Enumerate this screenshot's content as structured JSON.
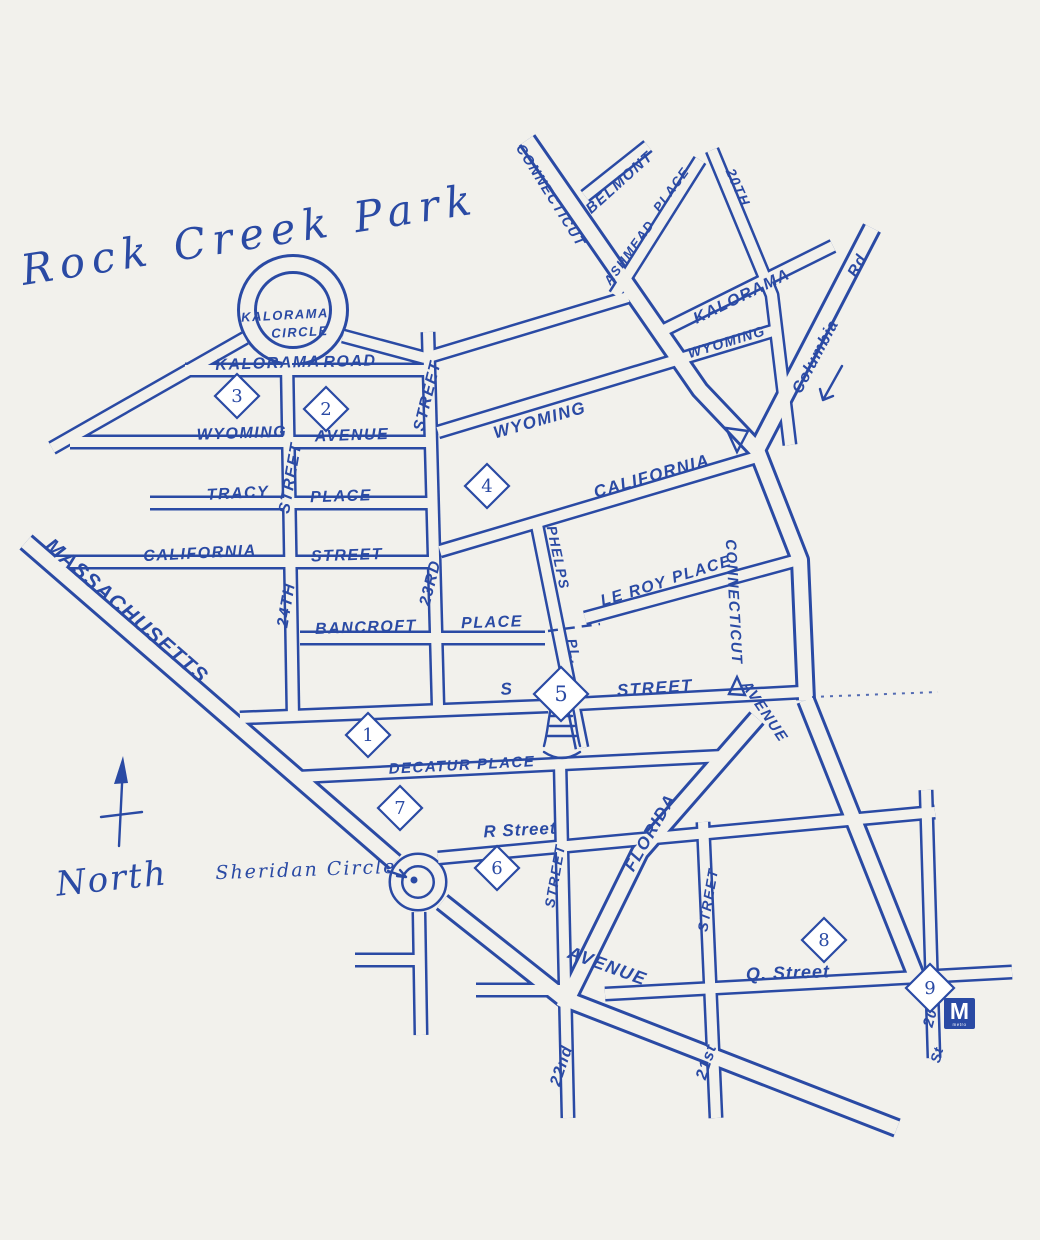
{
  "title": "Rock Creek Park",
  "colors": {
    "ink": "#2a4aa4",
    "paper": "#f2f1ec"
  },
  "labels": [
    {
      "id": "park-title",
      "text": "Rock Creek Park",
      "x": 250,
      "y": 238,
      "rot": -9,
      "size": 42,
      "cls": "script"
    },
    {
      "id": "kalorama-circle-line1",
      "text": "Kalorama",
      "x": 285,
      "y": 316,
      "rot": -3,
      "size": 13,
      "cls": "hand"
    },
    {
      "id": "kalorama-circle-line2",
      "text": "Circle",
      "x": 300,
      "y": 333,
      "rot": -3,
      "size": 13,
      "cls": "hand"
    },
    {
      "id": "kalorama-road-1",
      "text": "Kalorama",
      "x": 268,
      "y": 364,
      "rot": -2,
      "size": 16,
      "cls": "hand"
    },
    {
      "id": "kalorama-road-2",
      "text": "Road",
      "x": 350,
      "y": 362,
      "rot": -2,
      "size": 16,
      "cls": "hand"
    },
    {
      "id": "wyoming-ave-w-1",
      "text": "Wyoming",
      "x": 242,
      "y": 434,
      "rot": -2,
      "size": 16,
      "cls": "hand"
    },
    {
      "id": "wyoming-ave-w-2",
      "text": "Avenue",
      "x": 352,
      "y": 436,
      "rot": -2,
      "size": 16,
      "cls": "hand"
    },
    {
      "id": "tracy-place-1",
      "text": "Tracy",
      "x": 238,
      "y": 494,
      "rot": -3,
      "size": 16,
      "cls": "hand"
    },
    {
      "id": "tracy-place-2",
      "text": "Place",
      "x": 341,
      "y": 497,
      "rot": -2,
      "size": 16,
      "cls": "hand"
    },
    {
      "id": "california-st-1",
      "text": "California",
      "x": 200,
      "y": 554,
      "rot": -3,
      "size": 16,
      "cls": "hand"
    },
    {
      "id": "california-st-2",
      "text": "Street",
      "x": 347,
      "y": 556,
      "rot": -2,
      "size": 16,
      "cls": "hand"
    },
    {
      "id": "bancroft-1",
      "text": "Bancroft",
      "x": 366,
      "y": 628,
      "rot": -2,
      "size": 16,
      "cls": "hand"
    },
    {
      "id": "bancroft-2",
      "text": "Place",
      "x": 492,
      "y": 623,
      "rot": -2,
      "size": 16,
      "cls": "hand"
    },
    {
      "id": "s-street-1",
      "text": "S",
      "x": 507,
      "y": 690,
      "rot": -5,
      "size": 17,
      "cls": "hand"
    },
    {
      "id": "s-street-2",
      "text": "Street",
      "x": 655,
      "y": 689,
      "rot": -4,
      "size": 17,
      "cls": "hand"
    },
    {
      "id": "decatur-place",
      "text": "Decatur Place",
      "x": 462,
      "y": 766,
      "rot": -3,
      "size": 15,
      "cls": "hand"
    },
    {
      "id": "r-street",
      "text": "R Street",
      "x": 520,
      "y": 831,
      "rot": -3,
      "size": 17,
      "cls": "hand2"
    },
    {
      "id": "q-street",
      "text": "Q. Street",
      "x": 788,
      "y": 974,
      "rot": -2,
      "size": 18,
      "cls": "hand2"
    },
    {
      "id": "massachusetts",
      "text": "Massachusetts",
      "x": 126,
      "y": 612,
      "rot": 41,
      "size": 21,
      "cls": "hand"
    },
    {
      "id": "massachusetts-avenue",
      "text": "Avenue",
      "x": 607,
      "y": 967,
      "rot": 20,
      "size": 18,
      "cls": "hand"
    },
    {
      "id": "sheridan-circle",
      "text": "Sheridan Circle",
      "x": 306,
      "y": 871,
      "rot": -2,
      "size": 19,
      "cls": "script2"
    },
    {
      "id": "north",
      "text": "North",
      "x": 112,
      "y": 881,
      "rot": -6,
      "size": 34,
      "cls": "script2"
    },
    {
      "id": "street-24th-num",
      "text": "24th",
      "x": 287,
      "y": 605,
      "rot": -80,
      "size": 16,
      "cls": "hand"
    },
    {
      "id": "street-24th-word",
      "text": "Street",
      "x": 291,
      "y": 478,
      "rot": -80,
      "size": 16,
      "cls": "hand"
    },
    {
      "id": "street-23rd-num",
      "text": "23rd",
      "x": 431,
      "y": 583,
      "rot": -76,
      "size": 16,
      "cls": "hand"
    },
    {
      "id": "street-23rd-word",
      "text": "Street",
      "x": 428,
      "y": 396,
      "rot": -76,
      "size": 16,
      "cls": "hand"
    },
    {
      "id": "phelps-1",
      "text": "Phelps",
      "x": 557,
      "y": 558,
      "rot": 78,
      "size": 14,
      "cls": "hand"
    },
    {
      "id": "phelps-2",
      "text": "Pl.",
      "x": 573,
      "y": 652,
      "rot": 78,
      "size": 14,
      "cls": "hand"
    },
    {
      "id": "leroy-1",
      "text": "Le Roy",
      "x": 634,
      "y": 592,
      "rot": -17,
      "size": 16,
      "cls": "hand"
    },
    {
      "id": "leroy-2",
      "text": "Place",
      "x": 702,
      "y": 570,
      "rot": -17,
      "size": 16,
      "cls": "hand"
    },
    {
      "id": "wyoming-center",
      "text": "Wyoming",
      "x": 540,
      "y": 421,
      "rot": -16,
      "size": 17,
      "cls": "hand"
    },
    {
      "id": "california-center",
      "text": "California",
      "x": 652,
      "y": 477,
      "rot": -16,
      "size": 17,
      "cls": "hand"
    },
    {
      "id": "connecticut-top",
      "text": "Connecticut",
      "x": 550,
      "y": 196,
      "rot": 58,
      "size": 14,
      "cls": "hand"
    },
    {
      "id": "belmont",
      "text": "Belmont",
      "x": 620,
      "y": 183,
      "rot": -42,
      "size": 15,
      "cls": "hand"
    },
    {
      "id": "ashmead-1",
      "text": "Ashmead",
      "x": 630,
      "y": 253,
      "rot": -54,
      "size": 13,
      "cls": "hand"
    },
    {
      "id": "ashmead-2",
      "text": "Place",
      "x": 672,
      "y": 190,
      "rot": -54,
      "size": 13,
      "cls": "hand"
    },
    {
      "id": "street-20th-top",
      "text": "20th",
      "x": 737,
      "y": 188,
      "rot": 66,
      "size": 14,
      "cls": "hand"
    },
    {
      "id": "kalorama-ne",
      "text": "Kalorama",
      "x": 742,
      "y": 297,
      "rot": -26,
      "size": 16,
      "cls": "hand"
    },
    {
      "id": "wyoming-ne",
      "text": "Wyoming",
      "x": 727,
      "y": 343,
      "rot": -17,
      "size": 14,
      "cls": "hand"
    },
    {
      "id": "columbia-1",
      "text": "Columbia",
      "x": 816,
      "y": 357,
      "rot": -62,
      "size": 16,
      "cls": "hand2"
    },
    {
      "id": "columbia-2",
      "text": "Rd",
      "x": 858,
      "y": 266,
      "rot": -62,
      "size": 16,
      "cls": "hand2"
    },
    {
      "id": "connecticut-mid",
      "text": "Connecticut",
      "x": 733,
      "y": 602,
      "rot": 87,
      "size": 15,
      "cls": "hand"
    },
    {
      "id": "connecticut-avenue",
      "text": "Avenue",
      "x": 764,
      "y": 712,
      "rot": 56,
      "size": 15,
      "cls": "hand"
    },
    {
      "id": "florida",
      "text": "Florida",
      "x": 651,
      "y": 833,
      "rot": -60,
      "size": 17,
      "cls": "hand"
    },
    {
      "id": "street-22nd-upper",
      "text": "Street",
      "x": 556,
      "y": 876,
      "rot": -80,
      "size": 14,
      "cls": "hand"
    },
    {
      "id": "street-21st-upper",
      "text": "Street",
      "x": 709,
      "y": 900,
      "rot": -80,
      "size": 14,
      "cls": "hand"
    },
    {
      "id": "street-22nd",
      "text": "22nd",
      "x": 562,
      "y": 1066,
      "rot": -72,
      "size": 16,
      "cls": "hand2"
    },
    {
      "id": "street-21st",
      "text": "21st",
      "x": 707,
      "y": 1062,
      "rot": -72,
      "size": 16,
      "cls": "hand2"
    },
    {
      "id": "street-20-num",
      "text": "20",
      "x": 931,
      "y": 1018,
      "rot": -75,
      "size": 15,
      "cls": "hand2"
    },
    {
      "id": "street-20-word",
      "text": "St",
      "x": 938,
      "y": 1055,
      "rot": -75,
      "size": 14,
      "cls": "hand2"
    }
  ],
  "markers": [
    {
      "n": "1",
      "x": 368,
      "y": 735,
      "s": 22
    },
    {
      "n": "2",
      "x": 326,
      "y": 409,
      "s": 22
    },
    {
      "n": "3",
      "x": 237,
      "y": 396,
      "s": 22
    },
    {
      "n": "4",
      "x": 487,
      "y": 486,
      "s": 22
    },
    {
      "n": "5",
      "x": 561,
      "y": 694,
      "s": 27
    },
    {
      "n": "6",
      "x": 497,
      "y": 868,
      "s": 22
    },
    {
      "n": "7",
      "x": 400,
      "y": 808,
      "s": 22
    },
    {
      "n": "8",
      "x": 824,
      "y": 940,
      "s": 22
    },
    {
      "n": "9",
      "x": 930,
      "y": 988,
      "s": 24
    }
  ],
  "metro": {
    "letter": "M",
    "caption": "metro"
  }
}
